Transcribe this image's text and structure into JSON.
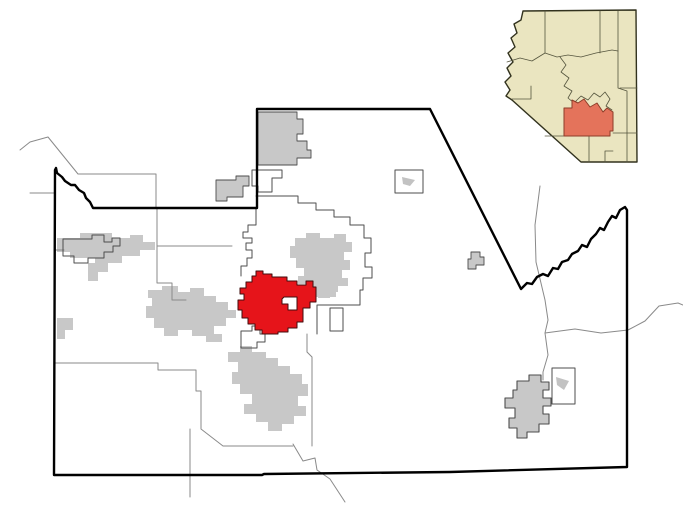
{
  "colors": {
    "background": "#ffffff",
    "county_border": "#000000",
    "highlight_red": "#e6141a",
    "highlight_outline": "#420d0d",
    "incorporated_gray": "#c8c8c8",
    "incorporated_gray_light": "#c2c2c2",
    "boundary_thin": "#8a8a8a",
    "boundary_dark": "#4d4d4d",
    "inset_state_fill": "#eae5c0",
    "inset_state_border": "#32321e",
    "inset_county_line": "#55553e",
    "inset_highlight_fill": "#e4735b",
    "inset_highlight_border": "#8d3c28"
  },
  "map": {
    "name": "county-locator-map",
    "width": 683,
    "height": 512,
    "shapes": [
      {
        "name": "gold-canyon-area",
        "fill": "$incorporated_gray",
        "stroke": "$boundary_dark",
        "sw": 0.9,
        "d": "M258,112 H297 V119 H303 V134 H297 V141 H307 V150 H311 V158 H297 V165 H258 Z"
      },
      {
        "name": "queen-valley-area",
        "fill": "$incorporated_gray",
        "stroke": "$boundary_dark",
        "sw": 0.9,
        "d": "M216,180 H236 V176 H249 V186 H243 V197 H227 V201 H216 Z"
      },
      {
        "name": "maricopa-city-area",
        "fill": "$incorporated_gray",
        "d": "M57,238 H80 V233 H112 V238 H130 V235 H143 V242 H155 V250 H140 V256 H122 V263 H95 V258 H70 V252 H57 Z"
      },
      {
        "name": "maricopa-south-area",
        "fill": "$incorporated_gray",
        "d": "M88,263 H108 V272 H98 V281 H88 Z"
      },
      {
        "name": "west-village-area",
        "fill": "$incorporated_gray",
        "d": "M57,318 H73 V330 H65 V339 H57 Z"
      },
      {
        "name": "central-cluster-area",
        "fill": "$incorporated_gray",
        "d": "M148,290 H162 V286 H178 V292 H190 V288 H204 V296 H216 V302 H228 V310 H236 V318 H226 V326 H214 V334 H222 V342 H206 V336 H192 V330 H178 V336 H164 V328 H154 V318 H146 V306 H152 V298 H148 Z"
      },
      {
        "name": "northeast-cluster-area",
        "fill": "$incorporated_gray",
        "d": "M295,238 H306 V233 H320 V238 H334 V234 H346 V242 H352 V252 H344 V260 H350 V270 H342 V278 H348 V286 H338 V292 H330 V298 H318 V290 H308 V284 H298 V276 H304 V268 H296 V258 H290 V246 H295 Z"
      },
      {
        "name": "east-arm-area",
        "fill": "$incorporated_gray",
        "d": "M311,286 H336 V297 H311 Z"
      },
      {
        "name": "south-cluster-area",
        "fill": "$incorporated_gray",
        "d": "M228,352 H240 V346 H252 V352 H266 V358 H278 V366 H290 V374 H302 V384 H308 V396 H298 V406 H306 V416 H294 V424 H282 V431 H268 V422 H256 V414 H244 V404 H252 V394 H240 V384 H232 V372 H238 V362 H228 Z"
      },
      {
        "name": "airport-strip",
        "fill": "$incorporated_gray_light",
        "d": "M402,177 L415,180 L410,186 L403,184 Z"
      },
      {
        "name": "east-small-area",
        "fill": "$incorporated_gray",
        "stroke": "$boundary_dark",
        "sw": 0.9,
        "d": "M471,252 H480 V257 H484 V265 H476 V269 H468 V259 H471 Z"
      },
      {
        "name": "san-manuel-area",
        "fill": "$incorporated_gray",
        "stroke": "$boundary_dark",
        "sw": 1.1,
        "d": "M517,381 H529 V375 H541 V382 H549 V390 H543 V398 H551 V406 H543 V414 H549 V424 H539 V432 H527 V438 H517 V428 H509 V418 H515 V408 H505 V398 H513 V390 H517 Z"
      },
      {
        "name": "rectangle-strip-area",
        "fill": "$incorporated_gray_light",
        "d": "M556,377 L569,381 L564,390 L557,385 Z"
      },
      {
        "name": "northwest-boundary-line",
        "stroke": "$boundary_thin",
        "sw": 1,
        "d": "M20,150 L30,142 L48,137 L78,174 L156,174 L156,208"
      },
      {
        "name": "west-stub-line",
        "stroke": "$boundary_thin",
        "sw": 1,
        "d": "M30,193 L54,193"
      },
      {
        "name": "west-stub-line-2",
        "stroke": "$boundary_thin",
        "sw": 1,
        "d": "M54,250 L64,250"
      },
      {
        "name": "notch-boundary-line",
        "stroke": "$boundary_thin",
        "sw": 1,
        "d": "M157,209 V246 H232"
      },
      {
        "name": "central-step-line",
        "stroke": "$boundary_thin",
        "sw": 1,
        "d": "M157,246 V283 H172 V300 H186"
      },
      {
        "name": "southwest-boundary-line",
        "stroke": "$boundary_thin",
        "sw": 1,
        "d": "M54,363 H158 V370 H196 V391 H201 V429 L223,446 H293"
      },
      {
        "name": "south-tail-line",
        "stroke": "$boundary_thin",
        "sw": 1,
        "d": "M190,429 V497"
      },
      {
        "name": "florence-south-line",
        "stroke": "$boundary_thin",
        "sw": 1,
        "d": "M307,334 V352 L312,357 V446"
      },
      {
        "name": "south-wiggle-line",
        "stroke": "$boundary_thin",
        "sw": 1,
        "d": "M293,444 L303,461 L315,458 L317,470 L330,479 L345,502"
      },
      {
        "name": "east-long-line",
        "stroke": "$boundary_thin",
        "sw": 1,
        "d": "M540,186 L535,225 L536,262 L545,300 L548,320 L545,333"
      },
      {
        "name": "east-branch-line",
        "stroke": "$boundary_thin",
        "sw": 1,
        "d": "M545,333 L575,329 L601,333 L628,330 L645,321 L659,306 L678,303 L683,305"
      },
      {
        "name": "east-south-line",
        "stroke": "$boundary_thin",
        "sw": 1,
        "d": "M545,333 L548,355 L543,372 L543,380"
      },
      {
        "name": "notch-polygon-outline",
        "stroke": "$boundary_dark",
        "sw": 1,
        "d": "M252,170 H282 V178 H272 V192 H258 V186 H252 Z"
      },
      {
        "name": "maricopa-outline",
        "stroke": "$boundary_dark",
        "sw": 1,
        "d": "M63,239 H92 V235 H104 V242 H112 V238 H120 V246 H113 V252 H104 V258 H88 V263 H74 V256 H63 Z"
      },
      {
        "name": "santan-boundary-outline",
        "stroke": "$boundary_dark",
        "sw": 1,
        "d": "M256,196 H298 V203 H316 V210 H334 V217 H350 V225 H364 V238 H371 V253 H365 V267 H372 V278 H363 V290 H360 V305 H317 V334"
      },
      {
        "name": "west-of-notch-line",
        "stroke": "$boundary_dark",
        "sw": 1,
        "d": "M256,209 V225 H248 V232 H243 V238 H252 V243 H246 V250 H252 V258 H247 V266 H241 V276"
      },
      {
        "name": "florence-rect-outline",
        "stroke": "$boundary_dark",
        "sw": 1,
        "d": "M330,308 H343 V331 H330 Z"
      },
      {
        "name": "airport-outline",
        "stroke": "$boundary_dark",
        "sw": 1,
        "d": "M395,170 H423 V193 H395 Z"
      },
      {
        "name": "southwest-dark-outline",
        "stroke": "$boundary_dark",
        "sw": 1,
        "d": "M241,331 H252 V326 H260 V334 H265 V342 H257 V348 H241 Z"
      },
      {
        "name": "san-manuel-rect-outline",
        "stroke": "$boundary_dark",
        "sw": 1,
        "d": "M552,368 H575 V404 H552 Z"
      },
      {
        "name": "highlighted-place-area",
        "fill": "$highlight_red",
        "stroke": "$highlight_outline",
        "sw": 1,
        "fr": "evenodd",
        "d": "M256,271 H263 V274 H272 V277 H287 V281 H297 V285 H306 V281 H313 V287 H316 V302 H310 V308 H303 V322 H297 V328 H288 V332 H278 V334 H262 V330 H255 V324 H248 V318 H242 V310 H238 V300 H244 V294 H240 V288 H246 V282 H252 V276 H256 Z M284,297 H297 V310 H288 V304 H282 V299 Z"
      },
      {
        "name": "county-boundary",
        "stroke": "$county_border",
        "sw": 2.4,
        "d": "M56,168 L57,173 L62,177 L65,181 L71,185 L75,185 L79,190 L84,193 L86,198 L90,202 L93,208 L257,208 L257,109 L430,109 L521,289 L527,283 L532,284 L537,277 L543,274 L548,276 L553,268 L558,269 L562,262 L568,260 L572,254 L578,251 L582,245 L587,247 L591,239 L596,234 L600,228 L604,230 L608,222 L612,216 L616,218 L620,210 L625,207 L627,210 L627,467 L450,472 L264,474 L262,475 L54,475 L55,170 Z"
      }
    ]
  },
  "inset": {
    "name": "state-locator-inset",
    "shapes": [
      {
        "name": "arizona-state-shape",
        "fill": "$inset_state_fill",
        "stroke": "$inset_state_border",
        "sw": 1.4,
        "d": "M523,11 L636,10 L637,162 L581,162 L512,100 L506,96 L510,90 L505,82 L511,76 L507,68 L513,62 L508,53 L515,47 L511,38 L517,33 L514,24 L521,20 Z"
      },
      {
        "name": "inset-county-line-1",
        "stroke": "$inset_county_line",
        "sw": 0.8,
        "d": "M545,11 V53"
      },
      {
        "name": "inset-county-line-2",
        "stroke": "$inset_county_line",
        "sw": 0.8,
        "d": "M507,62 L520,58 L532,61 L545,53 L557,57 L568,55 L581,57 L596,53 L612,50 L618,51"
      },
      {
        "name": "inset-county-line-3",
        "stroke": "$inset_county_line",
        "sw": 0.8,
        "d": "M600,11 V53"
      },
      {
        "name": "inset-county-line-4",
        "stroke": "$inset_county_line",
        "sw": 0.8,
        "d": "M618,11 V51"
      },
      {
        "name": "inset-county-line-5",
        "stroke": "$inset_county_line",
        "sw": 0.8,
        "d": "M618,51 V88 L627,91 V133"
      },
      {
        "name": "inset-county-line-6",
        "stroke": "$inset_county_line",
        "sw": 0.8,
        "d": "M620,88 H637"
      },
      {
        "name": "inset-county-line-7",
        "stroke": "$inset_county_line",
        "sw": 0.8,
        "d": "M560,57 L566,65 L561,72 L569,78 L564,86 L572,91 L568,98 L574,103"
      },
      {
        "name": "inset-county-line-8",
        "stroke": "$inset_county_line",
        "sw": 0.8,
        "d": "M574,103 L581,96 L588,100 L594,93 L600,97 L605,92 L610,99 L606,106 L612,110"
      },
      {
        "name": "inset-county-line-9",
        "stroke": "$inset_county_line",
        "sw": 0.8,
        "d": "M512,99 H531 M531,99 V86"
      },
      {
        "name": "inset-county-line-10",
        "stroke": "$inset_county_line",
        "sw": 0.8,
        "d": "M589,136 V162"
      },
      {
        "name": "inset-county-line-11",
        "stroke": "$inset_county_line",
        "sw": 0.8,
        "d": "M605,162 V151 H613"
      },
      {
        "name": "inset-county-line-12",
        "stroke": "$inset_county_line",
        "sw": 0.8,
        "d": "M613,133 H637"
      },
      {
        "name": "inset-county-line-13",
        "stroke": "$inset_county_line",
        "sw": 0.8,
        "d": "M627,133 V162"
      },
      {
        "name": "inset-county-line-14",
        "stroke": "$inset_county_line",
        "sw": 0.8,
        "d": "M564,136 H545"
      },
      {
        "name": "inset-highlighted-county",
        "fill": "$inset_highlight_fill",
        "stroke": "$inset_highlight_border",
        "sw": 1,
        "d": "M564,108 V136 H610 V131 H613 V112 L607,108 L603,112 L597,103 L590,107 L584,99 L578,103 L572,100 L572,108 Z"
      }
    ]
  }
}
